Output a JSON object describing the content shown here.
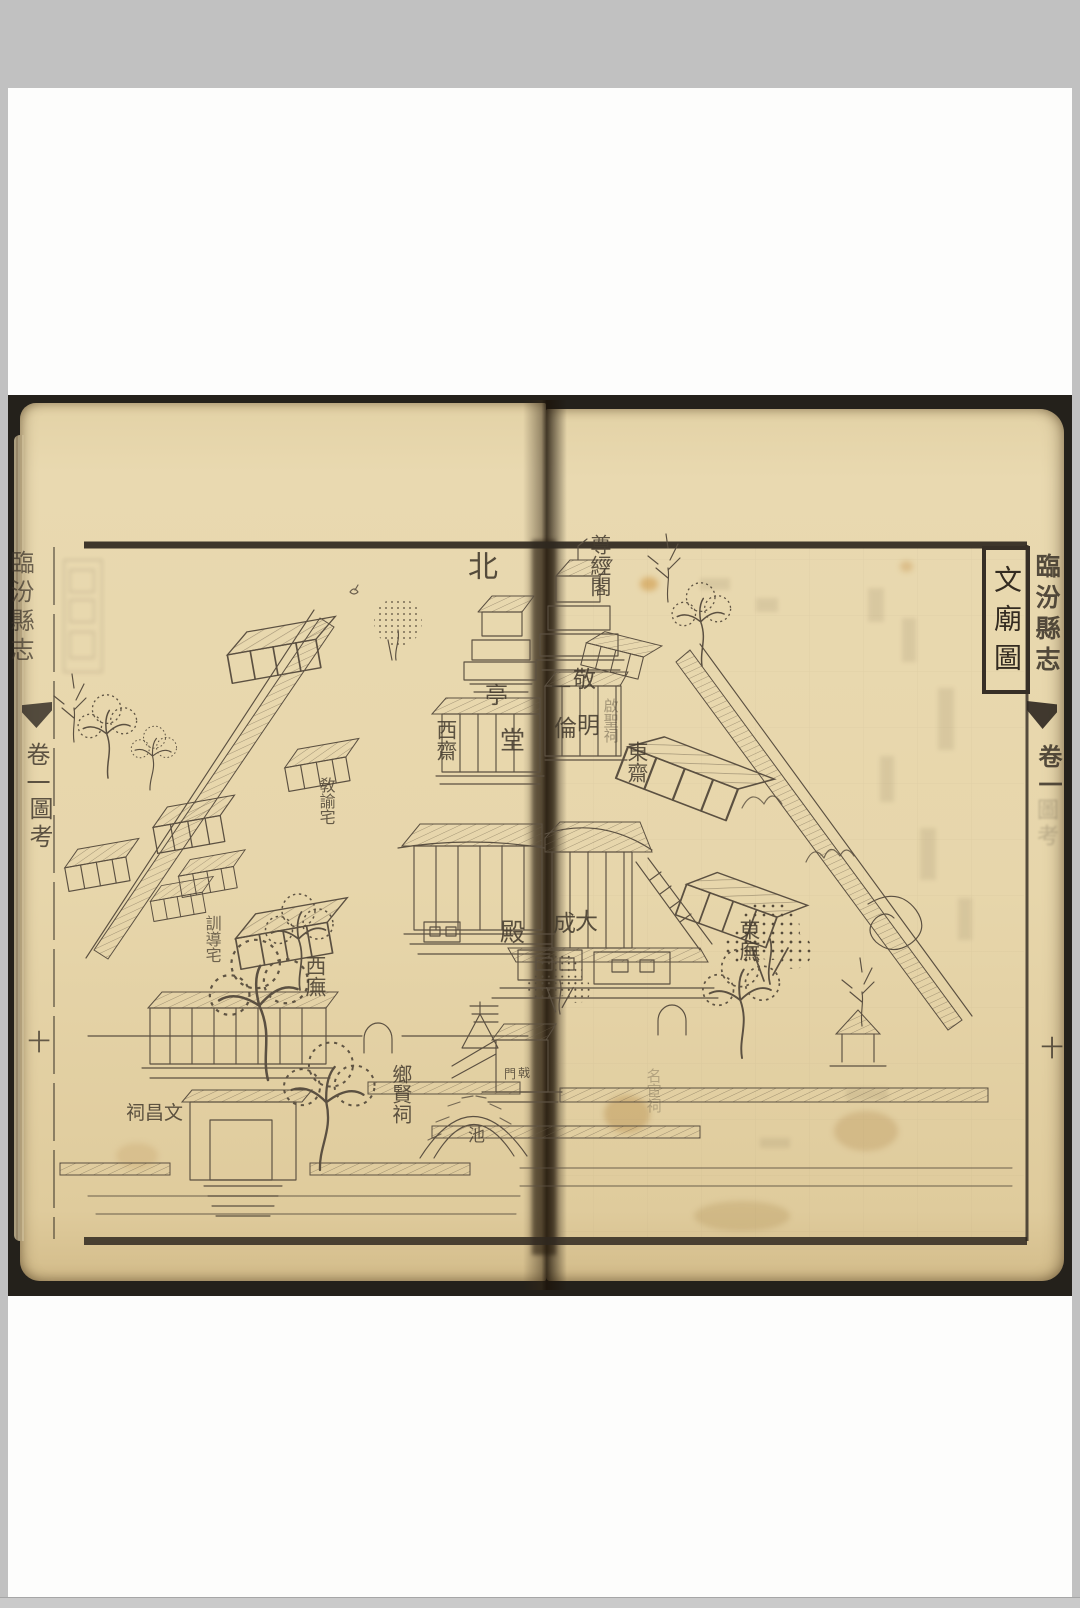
{
  "book": {
    "spine_title": "臨汾縣志",
    "volume": "卷一",
    "section": "圖考",
    "page_number": "十",
    "map_title": "文廟圖"
  },
  "map": {
    "compass_north": "北",
    "place_names": [
      "尊經閣",
      "敬一亭",
      "明倫堂",
      "啟聖祠",
      "東齋",
      "西齋",
      "敎諭宅",
      "訓導宅",
      "大成殿",
      "東廡",
      "西廡",
      "戟門",
      "鄉賢祠",
      "名宦祠",
      "池",
      "文昌祠"
    ],
    "labels": [
      {
        "text": "北",
        "x": 468,
        "y": 552,
        "o": "h",
        "s": 30,
        "op": 0.9
      },
      {
        "text": "尊經閣",
        "x": 588,
        "y": 534,
        "o": "v",
        "s": 21,
        "op": 0.85
      },
      {
        "text": "敬",
        "x": 573,
        "y": 669,
        "o": "h",
        "s": 23,
        "op": 0.88
      },
      {
        "text": "一",
        "x": 551,
        "y": 677,
        "o": "h",
        "s": 20,
        "op": 0.88
      },
      {
        "text": "亭",
        "x": 485,
        "y": 685,
        "o": "h",
        "s": 23,
        "op": 0.88
      },
      {
        "text": "明",
        "x": 577,
        "y": 715,
        "o": "h",
        "s": 23,
        "op": 0.88
      },
      {
        "text": "倫",
        "x": 554,
        "y": 718,
        "o": "h",
        "s": 23,
        "op": 0.88
      },
      {
        "text": "堂",
        "x": 500,
        "y": 728,
        "o": "h",
        "s": 25,
        "op": 0.88
      },
      {
        "text": "啟聖祠",
        "x": 602,
        "y": 698,
        "o": "v",
        "s": 15,
        "op": 0.42
      },
      {
        "text": "東齋",
        "x": 625,
        "y": 741,
        "o": "v",
        "s": 21,
        "op": 0.85
      },
      {
        "text": "西齋",
        "x": 434,
        "y": 719,
        "o": "v",
        "s": 21,
        "op": 0.85
      },
      {
        "text": "敎諭宅",
        "x": 317,
        "y": 777,
        "o": "v",
        "s": 16,
        "op": 0.8
      },
      {
        "text": "訓導宅",
        "x": 203,
        "y": 915,
        "o": "v",
        "s": 16,
        "op": 0.75
      },
      {
        "text": "大",
        "x": 575,
        "y": 911,
        "o": "h",
        "s": 23,
        "op": 0.88
      },
      {
        "text": "成",
        "x": 553,
        "y": 913,
        "o": "h",
        "s": 23,
        "op": 0.88
      },
      {
        "text": "殿",
        "x": 500,
        "y": 920,
        "o": "h",
        "s": 25,
        "op": 0.88
      },
      {
        "text": "東廡",
        "x": 737,
        "y": 919,
        "o": "v",
        "s": 21,
        "op": 0.85
      },
      {
        "text": "西廡",
        "x": 303,
        "y": 955,
        "o": "v",
        "s": 21,
        "op": 0.85
      },
      {
        "text": "戟",
        "x": 518,
        "y": 1067,
        "o": "h",
        "s": 12,
        "op": 0.8
      },
      {
        "text": "門",
        "x": 504,
        "y": 1068,
        "o": "h",
        "s": 12,
        "op": 0.8
      },
      {
        "text": "鄉賢祠",
        "x": 390,
        "y": 1064,
        "o": "v",
        "s": 20,
        "op": 0.85
      },
      {
        "text": "名宦祠",
        "x": 645,
        "y": 1068,
        "o": "v",
        "s": 15,
        "op": 0.3
      },
      {
        "text": "池",
        "x": 468,
        "y": 1128,
        "o": "h",
        "s": 17,
        "op": 0.8
      },
      {
        "text": "祠昌文",
        "x": 126,
        "y": 1104,
        "o": "h",
        "s": 19,
        "op": 0.85
      }
    ]
  }
}
